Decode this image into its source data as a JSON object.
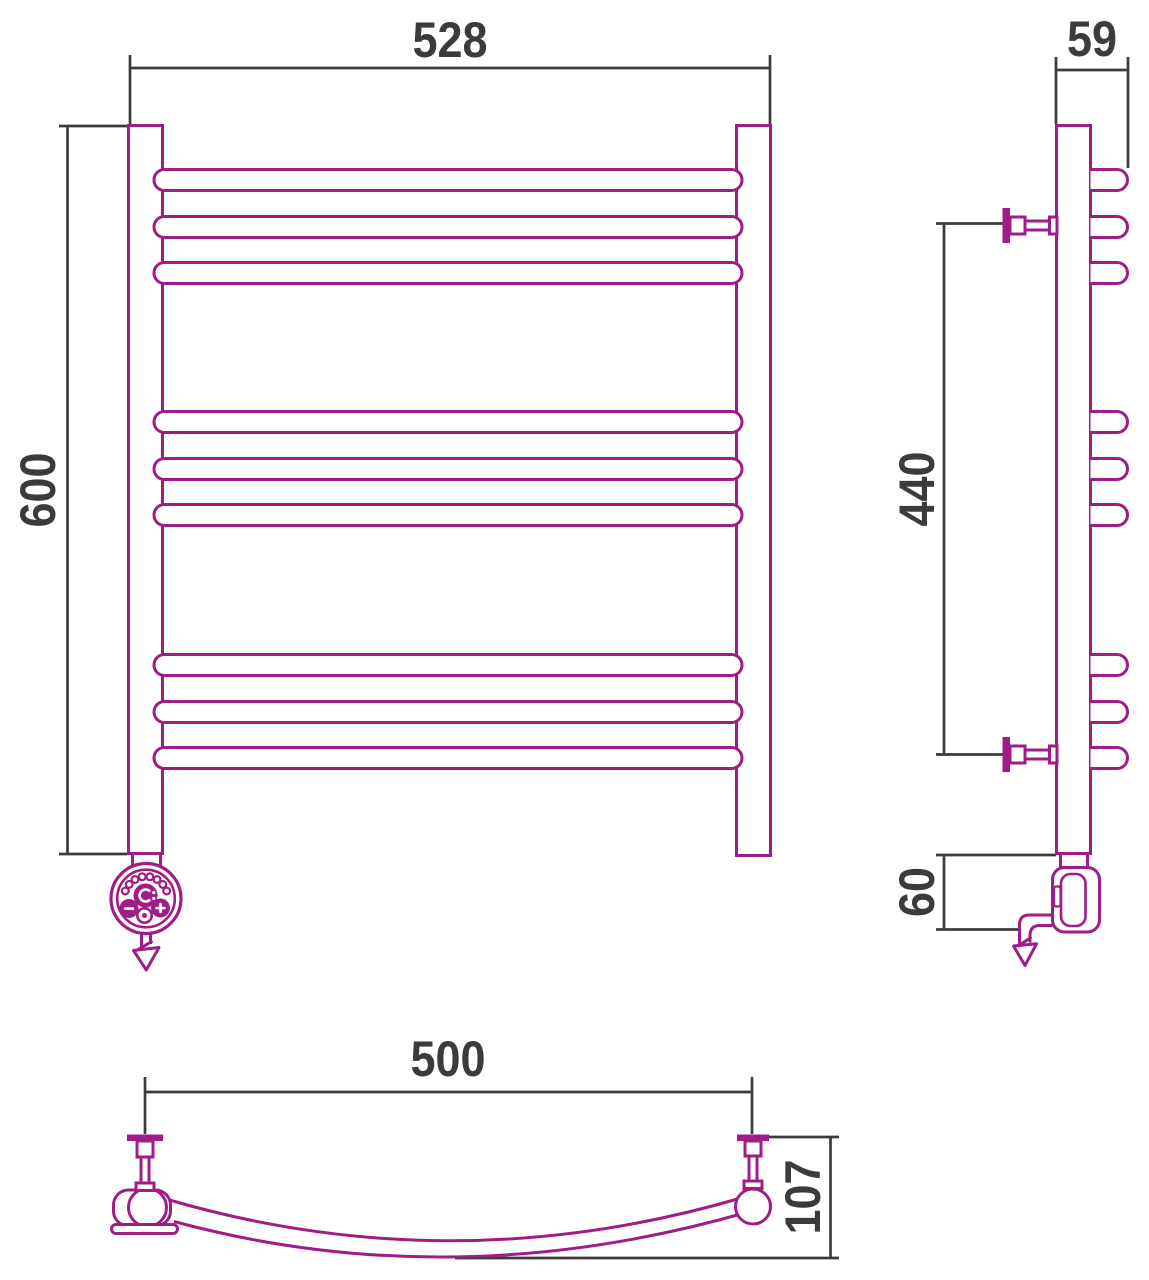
{
  "drawing": {
    "dimension_labels": {
      "front_width": "528",
      "front_height": "600",
      "side_depth": "59",
      "mount_spacing": "440",
      "element_height": "60",
      "plan_mount_width": "500",
      "plan_depth": "107"
    },
    "colors": {
      "product_outline": "#A01C87",
      "dimension_line": "#3B3B3E",
      "background": "#FFFFFF"
    },
    "element_controls": [
      "power-icon",
      "minus-icon",
      "plus-icon",
      "indicator-icon"
    ]
  }
}
